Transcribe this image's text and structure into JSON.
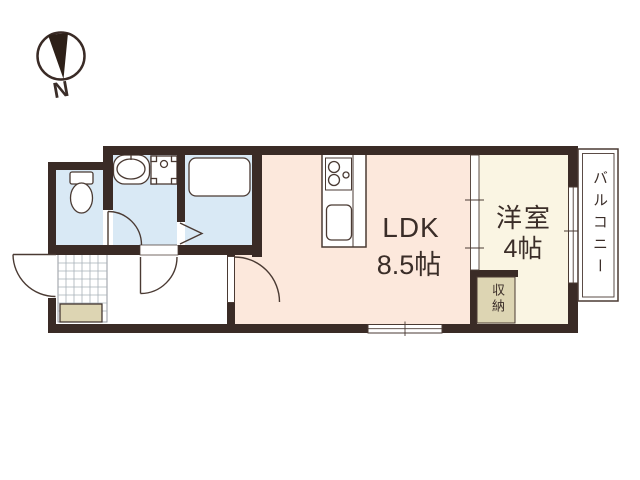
{
  "compass": {
    "label": "N"
  },
  "rooms": {
    "ldk": {
      "name": "LDK",
      "size": "8.5帖"
    },
    "western_room": {
      "name": "洋室",
      "size": "4帖"
    },
    "closet": {
      "name": "収納"
    },
    "balcony": {
      "name": "バルコニー"
    }
  },
  "colors": {
    "wall": "#3a2b26",
    "line": "#4a3a33",
    "water_room": "#d9e9f5",
    "ldk_floor": "#fce8dc",
    "western_floor": "#faf5e3",
    "closet_floor": "#ddd5b3",
    "tile_line": "#a8b0b8",
    "fixture_fill": "#ffffff",
    "text": "#3a2d28"
  }
}
